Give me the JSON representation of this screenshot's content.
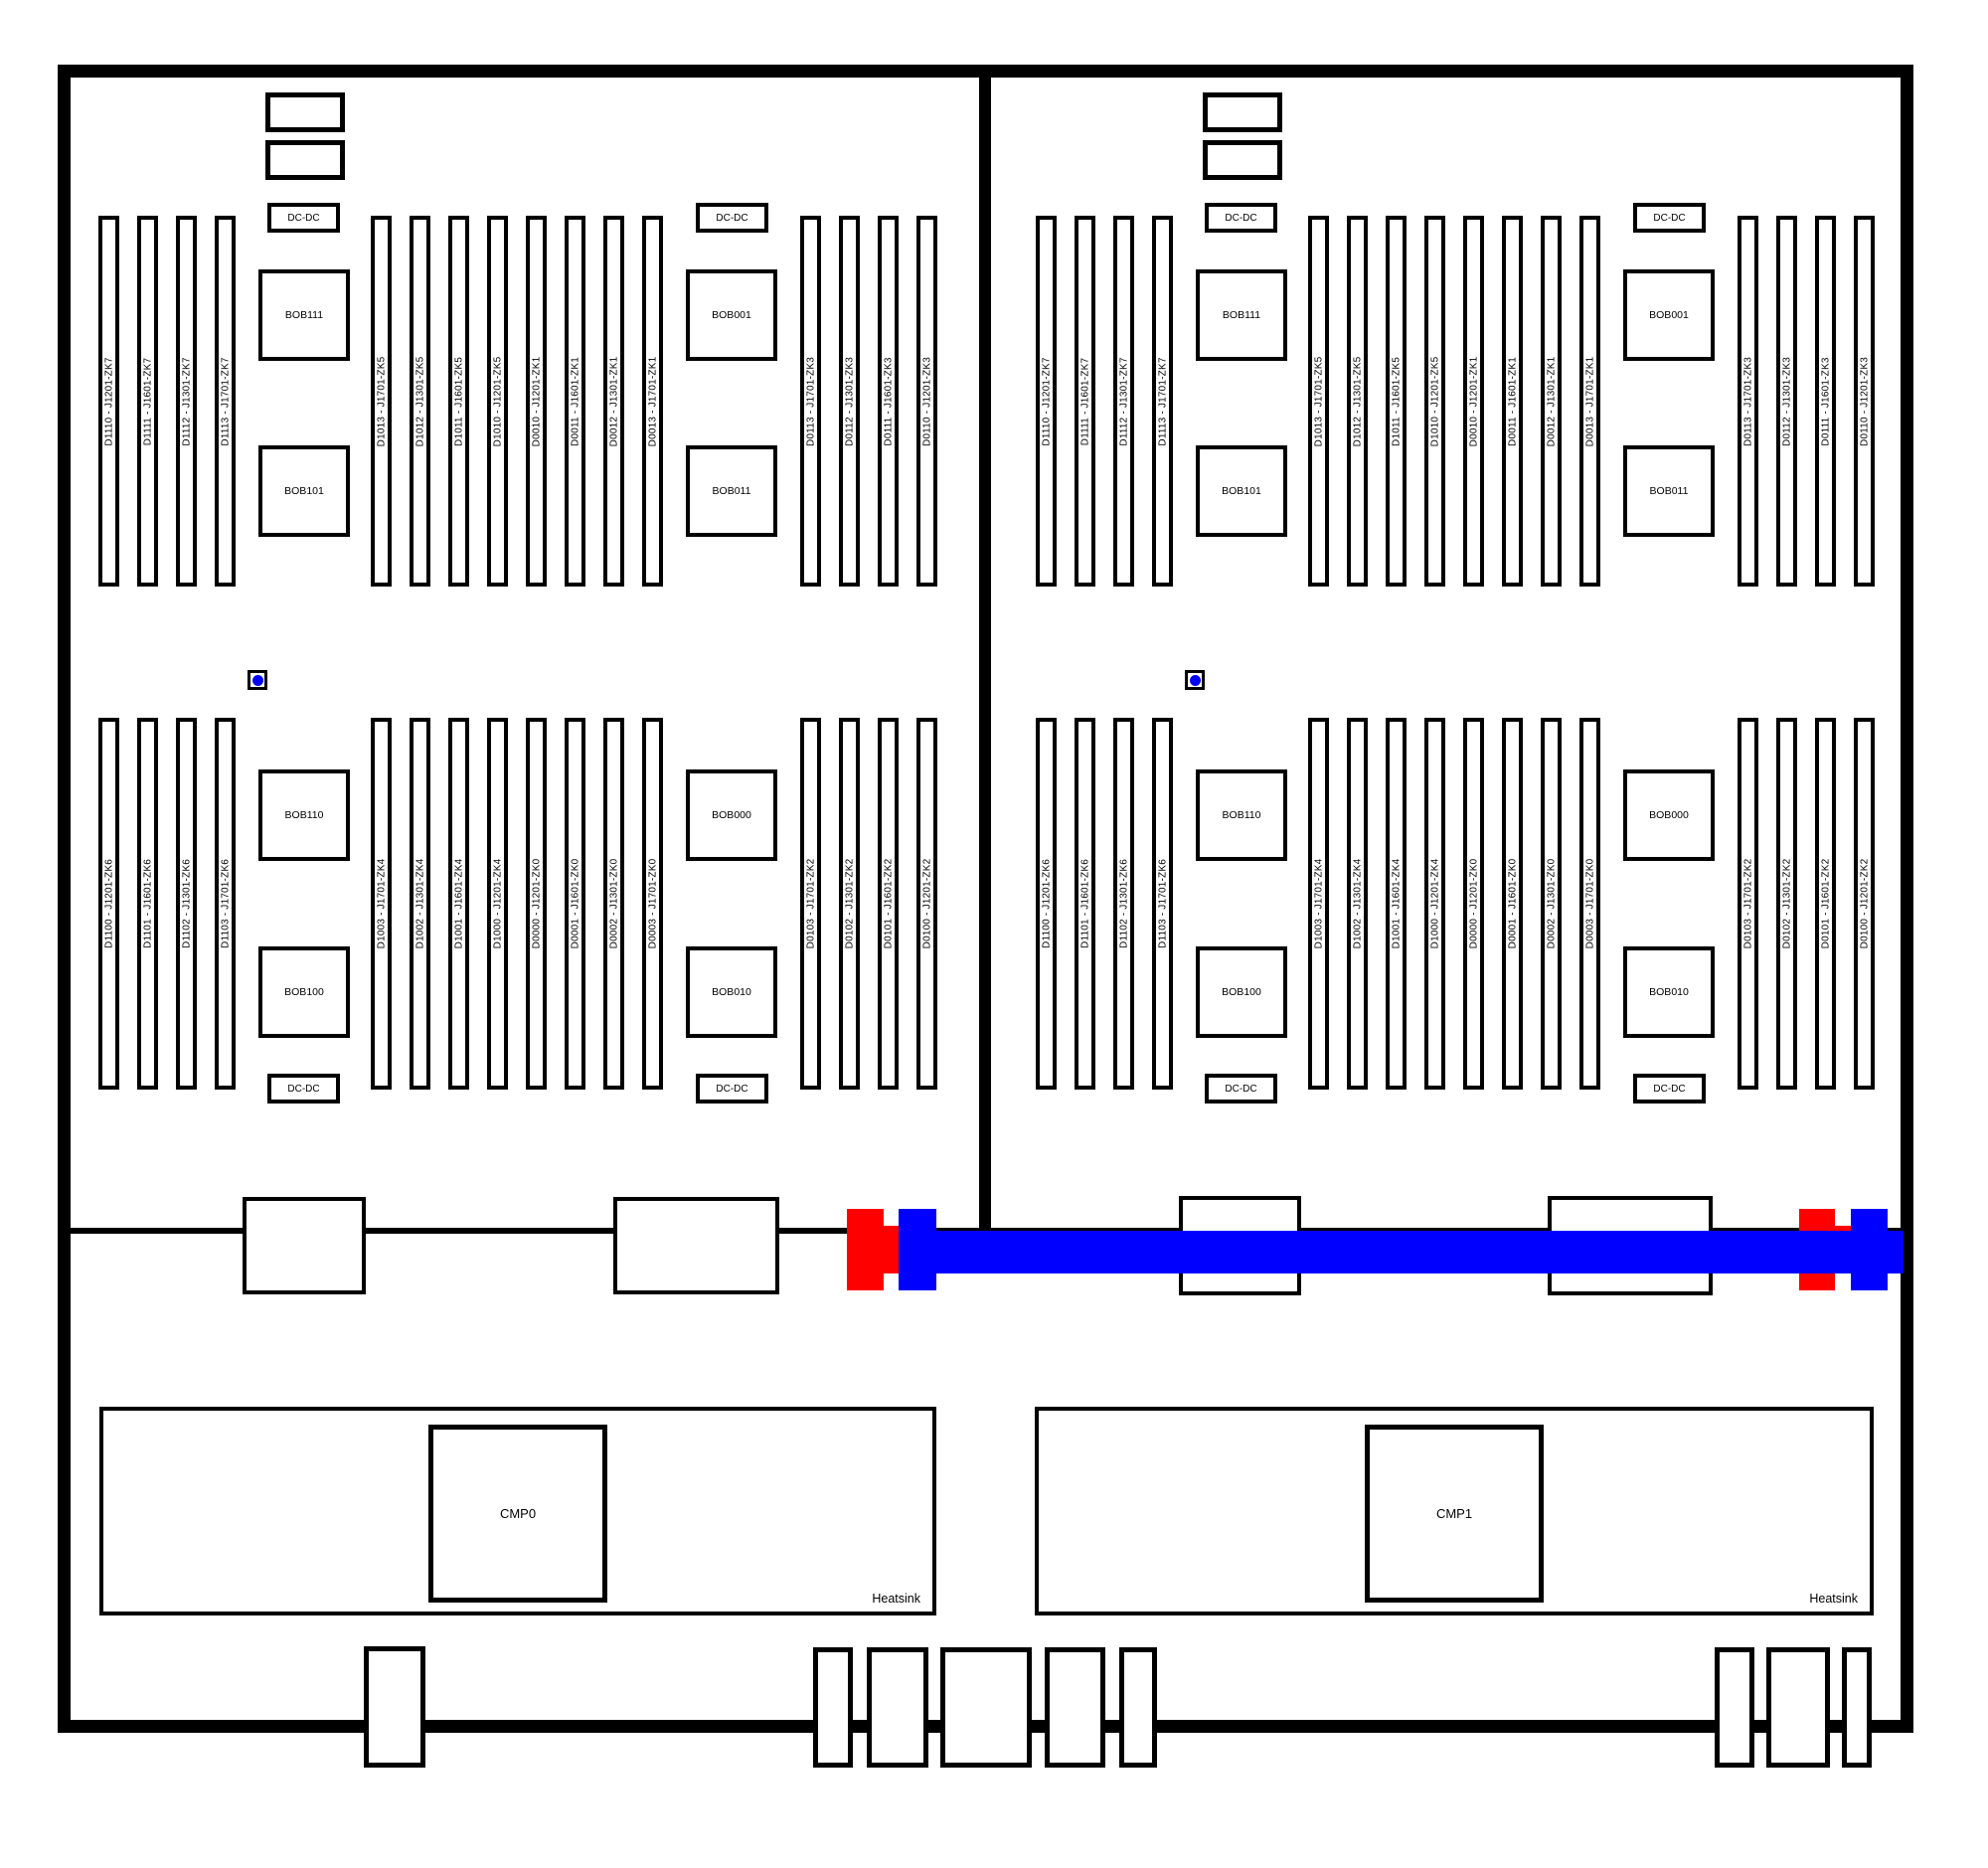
{
  "diagram": {
    "colors": {
      "cable_blue": "#0000ff",
      "connector_red": "#ff0000",
      "line_black": "#000000"
    },
    "sections": [
      {
        "side": "left",
        "dimm_rows": [
          {
            "groups": [
              {
                "slots": [
                  "D1110 - J1201-ZK7",
                  "D1111 - J1601-ZK7",
                  "D1112 - J1301-ZK7",
                  "D1113 - J1701-ZK7"
                ]
              },
              {
                "slots": [
                  "D1013 - J1701-ZK5",
                  "D1012 - J1301-ZK5",
                  "D1011 - J1601-ZK5",
                  "D1010 - J1201-ZK5",
                  "D0010 - J1201-ZK1",
                  "D0011 - J1601-ZK1",
                  "D0012 - J1301-ZK1",
                  "D0013 - J1701-ZK1"
                ]
              },
              {
                "slots": [
                  "D0113 - J1701-ZK3",
                  "D0112 - J1301-ZK3",
                  "D0111 - J1601-ZK3",
                  "D0110 - J1201-ZK3"
                ]
              }
            ]
          },
          {
            "groups": [
              {
                "slots": [
                  "D1100 - J1201-ZK6",
                  "D1101 - J1601-ZK6",
                  "D1102 - J1301-ZK6",
                  "D1103 - J1701-ZK6"
                ]
              },
              {
                "slots": [
                  "D1003 - J1701-ZK4",
                  "D1002 - J1301-ZK4",
                  "D1001 - J1601-ZK4",
                  "D1000 - J1201-ZK4",
                  "D0000 - J1201-ZK0",
                  "D0001 - J1601-ZK0",
                  "D0002 - J1301-ZK0",
                  "D0003 - J1701-ZK0"
                ]
              },
              {
                "slots": [
                  "D0103 - J1701-ZK2",
                  "D0102 - J1301-ZK2",
                  "D0101 - J1601-ZK2",
                  "D0100 - J1201-ZK2"
                ]
              }
            ]
          }
        ],
        "bobs": [
          "BOB111",
          "BOB101",
          "BOB001",
          "BOB011",
          "BOB110",
          "BOB100",
          "BOB000",
          "BOB010"
        ],
        "dcdc": [
          "DC-DC",
          "DC-DC",
          "DC-DC",
          "DC-DC"
        ]
      },
      {
        "side": "right",
        "dimm_rows": [
          {
            "groups": [
              {
                "slots": [
                  "D1110 - J1201-ZK7",
                  "D1111 - J1601-ZK7",
                  "D1112 - J1301-ZK7",
                  "D1113 - J1701-ZK7"
                ]
              },
              {
                "slots": [
                  "D1013 - J1701-ZK5",
                  "D1012 - J1301-ZK5",
                  "D1011 - J1601-ZK5",
                  "D1010 - J1201-ZK5",
                  "D0010 - J1201-ZK1",
                  "D0011 - J1601-ZK1",
                  "D0012 - J1301-ZK1",
                  "D0013 - J1701-ZK1"
                ]
              },
              {
                "slots": [
                  "D0113 - J1701-ZK3",
                  "D0112 - J1301-ZK3",
                  "D0111 - J1601-ZK3",
                  "D0110 - J1201-ZK3"
                ]
              }
            ]
          },
          {
            "groups": [
              {
                "slots": [
                  "D1100 - J1201-ZK6",
                  "D1101 - J1601-ZK6",
                  "D1102 - J1301-ZK6",
                  "D1103 - J1701-ZK6"
                ]
              },
              {
                "slots": [
                  "D1003 - J1701-ZK4",
                  "D1002 - J1301-ZK4",
                  "D1001 - J1601-ZK4",
                  "D1000 - J1201-ZK4",
                  "D0000 - J1201-ZK0",
                  "D0001 - J1601-ZK0",
                  "D0002 - J1301-ZK0",
                  "D0003 - J1701-ZK0"
                ]
              },
              {
                "slots": [
                  "D0103 - J1701-ZK2",
                  "D0102 - J1301-ZK2",
                  "D0101 - J1601-ZK2",
                  "D0100 - J1201-ZK2"
                ]
              }
            ]
          }
        ],
        "bobs": [
          "BOB111",
          "BOB101",
          "BOB001",
          "BOB011",
          "BOB110",
          "BOB100",
          "BOB000",
          "BOB010"
        ],
        "dcdc": [
          "DC-DC",
          "DC-DC",
          "DC-DC",
          "DC-DC"
        ]
      }
    ],
    "cpu_units": [
      {
        "cmp": "CMP0",
        "heatsink": "Heatsink"
      },
      {
        "cmp": "CMP1",
        "heatsink": "Heatsink"
      }
    ]
  }
}
